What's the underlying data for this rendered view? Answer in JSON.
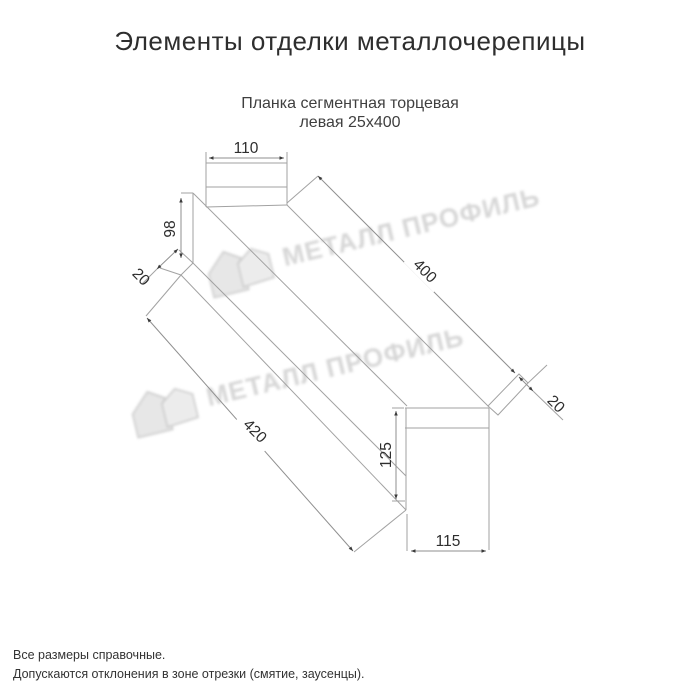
{
  "title": "Элементы отделки металлочерепицы",
  "product": {
    "name_line1": "Планка сегментная торцевая",
    "name_line2": "левая 25х400"
  },
  "drawing": {
    "type": "technical-dimension-sketch",
    "dimensions": {
      "top_flange_width": "110",
      "left_end_height": "98",
      "left_hem": "20",
      "top_edge_length": "400",
      "bottom_edge_length": "420",
      "right_hem": "20",
      "right_end_height": "125",
      "bottom_flange_width": "115"
    }
  },
  "watermark": {
    "text": "МЕТАЛЛ ПРОФИЛЬ",
    "logo": "metal-profile-roof-logo"
  },
  "footer": {
    "line1": "Все размеры справочные.",
    "line2": "Допускаются отклонения в зоне отрезки (смятие, заусенцы)."
  },
  "colors": {
    "background": "#ffffff",
    "drawing_lines": "#a2a2a2",
    "dimension_arrows": "#3a3a3a",
    "dimension_text": "#2e2e2e",
    "title_text": "#2e2e2e",
    "watermark_text": "#d4d4d4"
  }
}
